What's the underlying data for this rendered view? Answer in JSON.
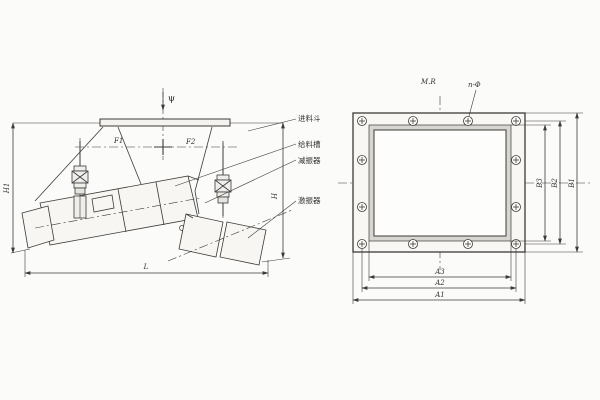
{
  "side_view": {
    "angle_label": "ψ",
    "dim_f1": "F1",
    "dim_f2": "F2",
    "dim_height_left": "H1",
    "dim_height_right": "H",
    "dim_length": "L",
    "part_labels": [
      {
        "text": "进料斗"
      },
      {
        "text": "给料槽"
      },
      {
        "text": "减振器"
      },
      {
        "text": "激振器"
      }
    ]
  },
  "flange_view": {
    "top_label": "M.R",
    "holes_label": "n-Φ",
    "vertical_dims": [
      "B3",
      "B2",
      "B1"
    ],
    "horizontal_dims": [
      "A3",
      "A2",
      "A1"
    ]
  },
  "style": {
    "line_color": "#3d3b38",
    "paper_color": "#fbfbf9",
    "flange_band_color": "#d8d6d0"
  }
}
